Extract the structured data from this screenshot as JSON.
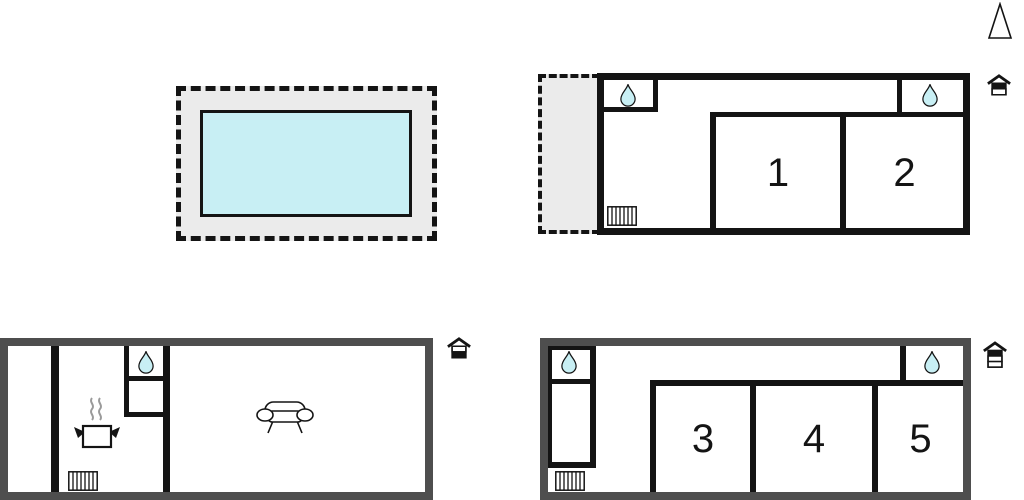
{
  "colors": {
    "wall_black": "#141414",
    "wall_gray": "#4e4e4e",
    "water_fill": "#c8eff4",
    "area_fill": "#ebebeb",
    "steam": "#9a9a9a",
    "label_text": "#141414"
  },
  "plans": {
    "upper_floor": {
      "rooms": [
        "1",
        "2"
      ]
    },
    "annex_floor": {
      "rooms": [
        "3",
        "4",
        "5"
      ]
    }
  },
  "icons": {
    "north_arrow": "north-arrow",
    "water_drop": "water-drop",
    "radiator": "radiator",
    "cooking_pot": "cooking-pot-with-steam",
    "sofa": "sofa",
    "house_upper": "house-2-floors-top-highlighted",
    "house_lower": "house-2-floors-bottom-highlighted",
    "house_annex": "house-3-floors-top-highlighted"
  }
}
